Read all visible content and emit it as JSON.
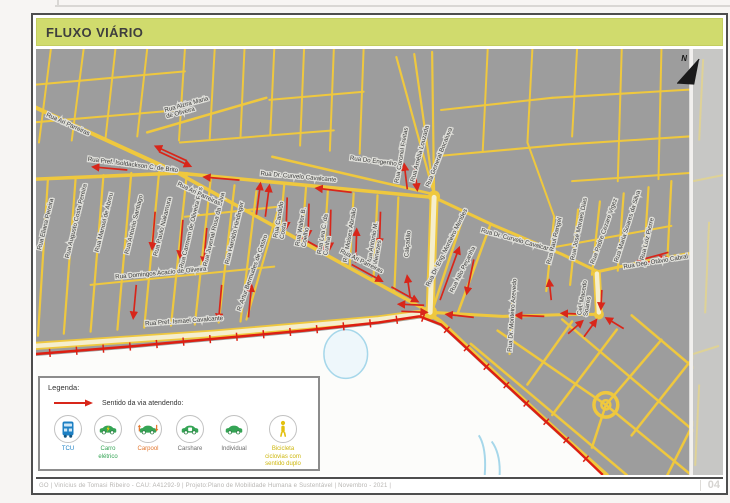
{
  "title": "FLUXO VIÁRIO",
  "page_number": "04",
  "footer_text": "GO | Vinícius de Tomasi Ribeiro  -  CAU: A41292-9 | Projeto:Plano de Mobilidade Humana e Sustentável | Novembro - 2021 |",
  "legend": {
    "title": "Legenda:",
    "arrow_label": "Sentido da via atendendo:",
    "items": [
      {
        "id": "tcu",
        "line1": "TCU",
        "line2": ""
      },
      {
        "id": "electric-car",
        "line1": "Carro",
        "line2": "elétrico"
      },
      {
        "id": "carpool",
        "line1": "Carpool",
        "line2": ""
      },
      {
        "id": "carshare",
        "line1": "Carshare",
        "line2": ""
      },
      {
        "id": "individual",
        "line1": "Individual",
        "line2": ""
      }
    ],
    "bike": {
      "line1": "Bicicleta",
      "line2": "ciclovias com sentido duplo"
    }
  },
  "map": {
    "north_label": "N",
    "street_labels": [
      {
        "text": "Rua Ari Parreiras",
        "x": 10,
        "y": 66,
        "r": 24
      },
      {
        "text": "Rua Alzira Maria",
        "text2": "de Oliveira",
        "x": 130,
        "y": 62,
        "r": -15
      },
      {
        "text": "Rua Pref. Isoldackson C. de Brito",
        "x": 52,
        "y": 110,
        "r": 7
      },
      {
        "text": "Rua Do Engenho",
        "x": 316,
        "y": 109,
        "r": 7
      },
      {
        "text": "Rua Dr. Curvelo Cavalcante",
        "x": 226,
        "y": 124,
        "r": 5
      },
      {
        "text": "Rua General Bocaiuva",
        "x": 396,
        "y": 136,
        "r": -68
      },
      {
        "text": "Rua Amélia Louzada",
        "x": 381,
        "y": 131,
        "r": -75
      },
      {
        "text": "Rua Coronel Freitas",
        "x": 365,
        "y": 132,
        "r": -80
      },
      {
        "text": "Rua Eliana Pereira",
        "x": 5,
        "y": 198,
        "r": -76
      },
      {
        "text": "Rua Augusto Costa Pereira",
        "x": 33,
        "y": 206,
        "r": -76
      },
      {
        "text": "Rua Manoel de Abreu",
        "x": 63,
        "y": 200,
        "r": -76
      },
      {
        "text": "Rua Antonio Santiago",
        "x": 93,
        "y": 202,
        "r": -76
      },
      {
        "text": "Rua Paulo Nakamura",
        "x": 122,
        "y": 204,
        "r": -76
      },
      {
        "text": "Rua Carmem de Oliveira Reis",
        "x": 148,
        "y": 216,
        "r": -76
      },
      {
        "text": "Rua Juvenal Rosa da Silva",
        "x": 172,
        "y": 214,
        "r": -76
      },
      {
        "text": "Rua Haroldo Hindinger",
        "x": 194,
        "y": 212,
        "r": -76
      },
      {
        "text": "Rua Ari Parreiras",
        "x": 142,
        "y": 134,
        "r": 25
      },
      {
        "text": "Rua Domingos Acacio de Oliveira",
        "x": 80,
        "y": 226,
        "r": -5
      },
      {
        "text": "R. Artur Bermudes de Castro",
        "x": 206,
        "y": 258,
        "r": -70
      },
      {
        "text": "Rua Candido",
        "text2": "Costa",
        "x": 243,
        "y": 186,
        "r": -80
      },
      {
        "text": "Rua Walter B.",
        "text2": "Coelho",
        "x": 265,
        "y": 194,
        "r": -80
      },
      {
        "text": "Rua Lea C. da",
        "text2": "Cunha",
        "x": 287,
        "y": 202,
        "r": -80
      },
      {
        "text": "Rua Moises Abraão",
        "x": 313,
        "y": 210,
        "r": -80
      },
      {
        "text": "Rua Antonio M.",
        "text2": "Menezes",
        "x": 337,
        "y": 212,
        "r": -80
      },
      {
        "text": "Rua Ari Parreiras",
        "x": 306,
        "y": 200,
        "r": 26
      },
      {
        "text": "Calçadão",
        "x": 375,
        "y": 205,
        "r": -85
      },
      {
        "text": "Rua Dr. Eng. Monteiro Mendes",
        "x": 396,
        "y": 234,
        "r": -63
      },
      {
        "text": "Rua Nilo Peçanha",
        "x": 420,
        "y": 240,
        "r": -63
      },
      {
        "text": "Rua Dr. Curvelo Cavalcante",
        "x": 448,
        "y": 180,
        "r": 15
      },
      {
        "text": "Rua Raul Rangel",
        "x": 518,
        "y": 212,
        "r": -76
      },
      {
        "text": "Rua José Moraes Dias",
        "x": 542,
        "y": 208,
        "r": -78
      },
      {
        "text": "Rua Padre Cezare Vigez",
        "x": 562,
        "y": 212,
        "r": -70
      },
      {
        "text": "Rua Maria Soares da Silva",
        "x": 586,
        "y": 210,
        "r": -72
      },
      {
        "text": "Rua Luiz Pierre",
        "x": 612,
        "y": 208,
        "r": -76
      },
      {
        "text": "Rua Dep. Otávio Cabral",
        "x": 592,
        "y": 216,
        "r": -9
      },
      {
        "text": "Cel. Macedo",
        "text2": "Soares",
        "x": 549,
        "y": 262,
        "r": -80
      },
      {
        "text": "Rua Dr. Monteiro Azevedo",
        "x": 479,
        "y": 298,
        "r": -86
      },
      {
        "text": "Rua Pref. Ismael Cavalcante",
        "x": 110,
        "y": 272,
        "r": -4
      }
    ]
  },
  "colors": {
    "title_band": "#d0db6d",
    "map_gray": "#9d9d9d",
    "street_yellow": "#efc83e",
    "flow_arrow_red": "#d8261a",
    "bike_line_red": "#dd1f12",
    "tcu_blue": "#1d80c4",
    "car_green": "#35a455",
    "carpool_orange": "#e2762d",
    "bike_yellow": "#cdb60b"
  }
}
